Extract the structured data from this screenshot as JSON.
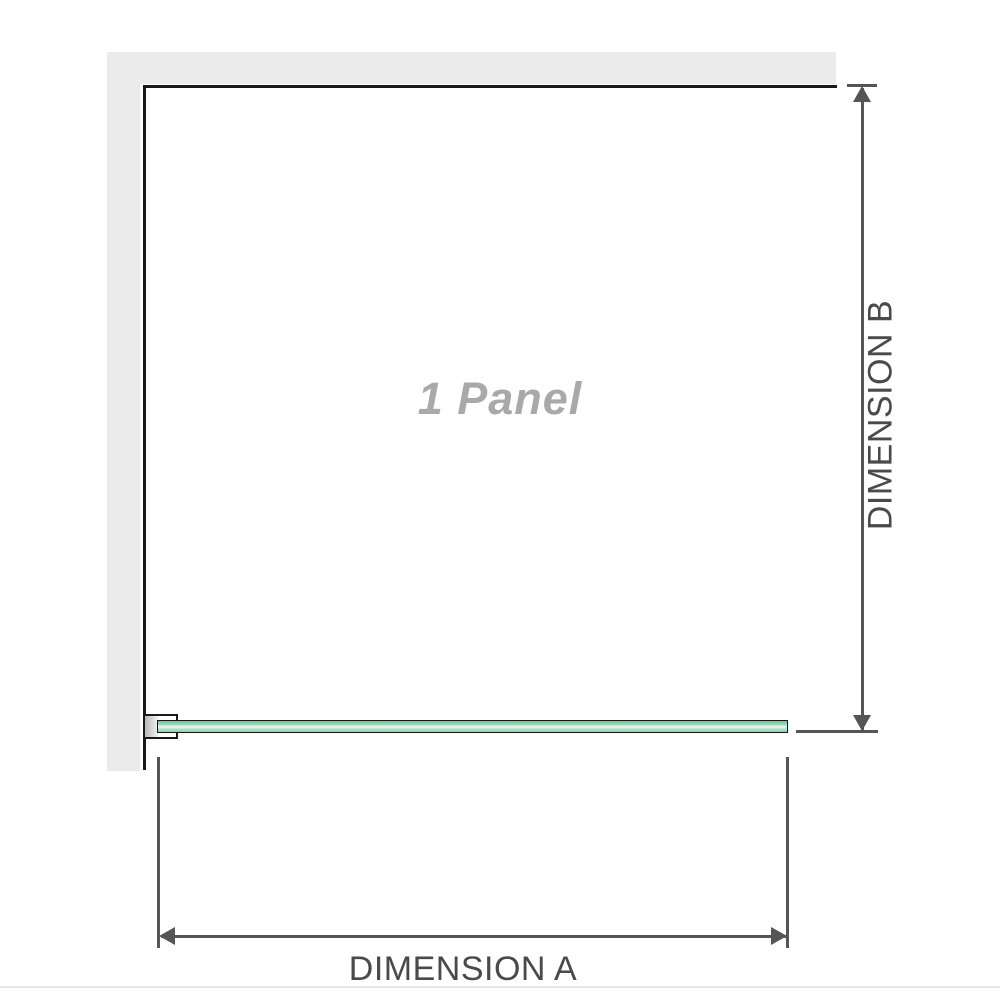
{
  "diagram": {
    "labels": {
      "panel": "1 Panel",
      "dimension_a": "DIMENSION A",
      "dimension_b": "DIMENSION B"
    }
  },
  "colors": {
    "wall": "#ebebeb",
    "wall_edge": "#1a1a1a",
    "dimension": "#555555",
    "label_text": "#4a4a4a",
    "panel_text": "#a9a9a9",
    "glass_border": "#161616",
    "glass_green": "#8fcfae",
    "glass_highlight": "#ecf9f2",
    "bracket_shim": "#b8b8b8",
    "bottom_rule": "#e9e7e3"
  }
}
